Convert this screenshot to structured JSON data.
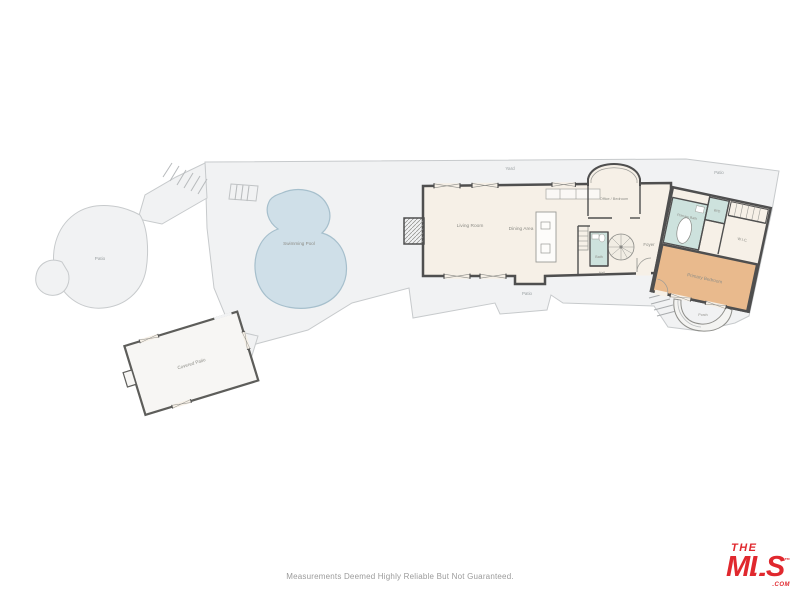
{
  "footer": {
    "disclaimer": "Measurements Deemed Highly Reliable But Not Guaranteed.",
    "logo": {
      "the": "THE",
      "mls": "MLS",
      "tm": "™",
      "com": ".COM",
      "color": "#e0282e"
    }
  },
  "floor_plan": {
    "outdoor": {
      "yard": "Yard",
      "patio_left": "Patio",
      "patio_bottom": "Patio",
      "patio_top_right": "Patio",
      "swimming_pool": "Swimming Pool",
      "porch": "Porch"
    },
    "outbuilding": {
      "covered_patio": "Covered Patio"
    },
    "main_house": {
      "living_room": "Living Room",
      "dining_area": "Dining Area",
      "office_bedroom": "Office / Bedroom",
      "bath": "Bath",
      "foyer": "Foyer",
      "hall": "Hall"
    },
    "primary_suite": {
      "primary_bath": "Primary Bath",
      "wd": "W/D",
      "wic": "W.I.C.",
      "primary_bedroom": "Primary Bedroom"
    },
    "colors": {
      "outdoor_fill": "#f1f2f3",
      "outdoor_stroke": "#c7cacc",
      "pool_fill": "#cfdfe8",
      "pool_stroke": "#a6bfcc",
      "house_fill": "#f6f0e7",
      "wall": "#4f4f4f",
      "bath_fill": "#cde2dd",
      "bedroom_fill": "#e9ba8d",
      "label": "#8d8d87"
    }
  }
}
